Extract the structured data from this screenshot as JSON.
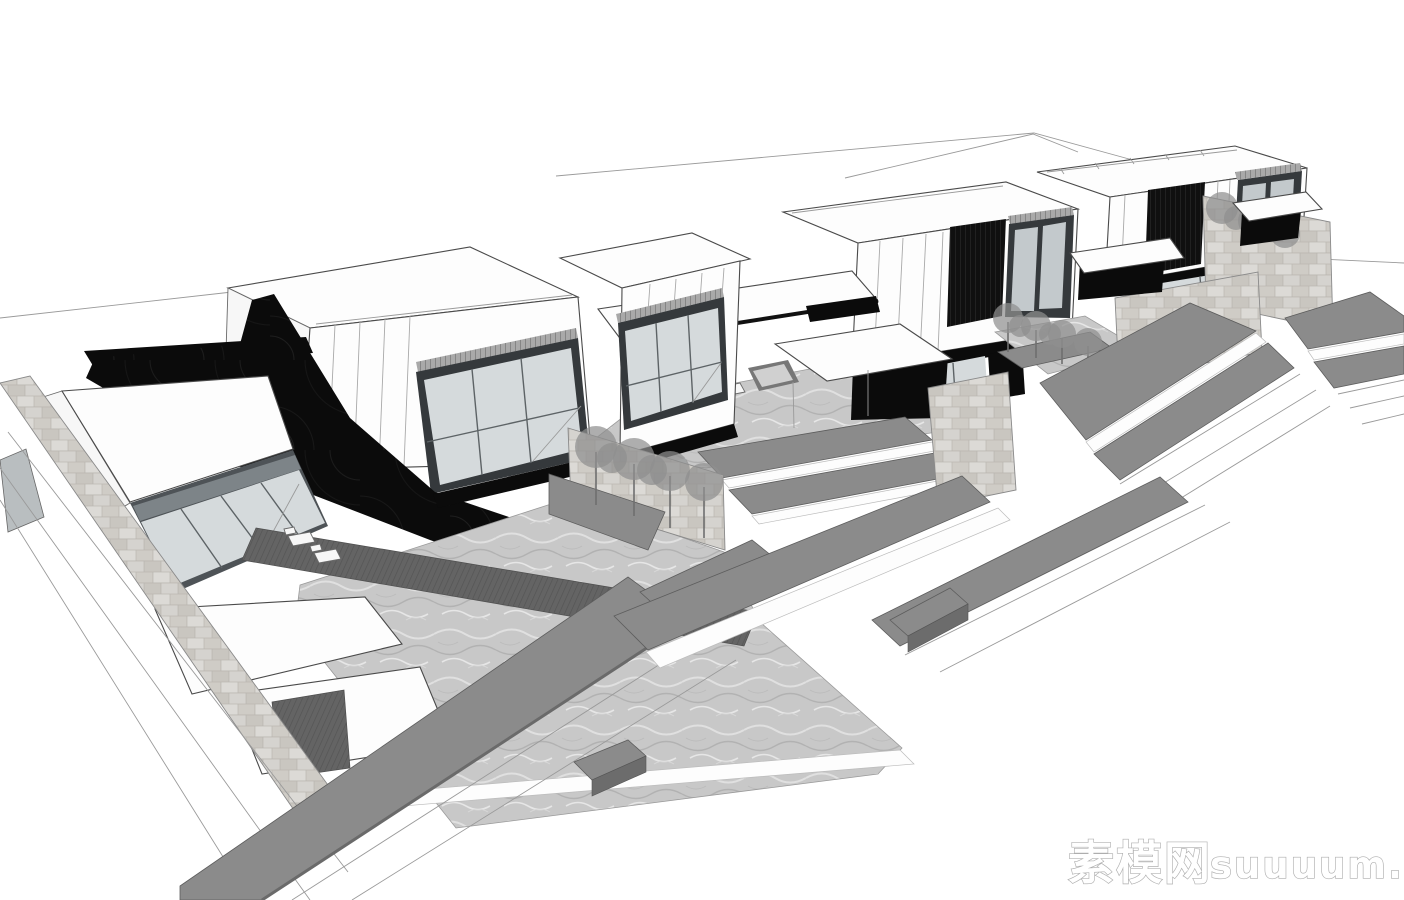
{
  "image": {
    "kind": "monochrome architectural 3d perspective rendering",
    "style": "sketchup-like line render, white background",
    "width": 1404,
    "height": 900
  },
  "watermark": {
    "cn": "素模网",
    "latin": "suuuum.com",
    "full": "素模网suuuum.com"
  },
  "scene": {
    "description": "Aerial view of a stepped row of modern flat-roof villas with glazed two-story boxes, stone courtyard walls with trees, water-textured pool decks, white pergolas and long gray stepped terraces descending to the lower right",
    "villa_count": 4,
    "elements": [
      "two-story glass box",
      "louver facade panel",
      "stone retaining wall",
      "courtyard pool deck",
      "garden wall with trees",
      "pergola with shadow",
      "lounge chairs",
      "terrace steps",
      "planter boxes",
      "cast shadow"
    ]
  },
  "palette": {
    "background": "#ffffff",
    "line": "#4a4a4a",
    "shadow_black": "#0b0b0b",
    "terrace_gray": "#8b8b8b",
    "terrace_side": "#6c6c6c",
    "glass": "#d5dadc",
    "glass_frame": "#35393c",
    "stone": "#d8d6d2",
    "water": "#c8c8c8",
    "tree": "#8f8f8f",
    "watermark_outline": "#aeaeae"
  }
}
